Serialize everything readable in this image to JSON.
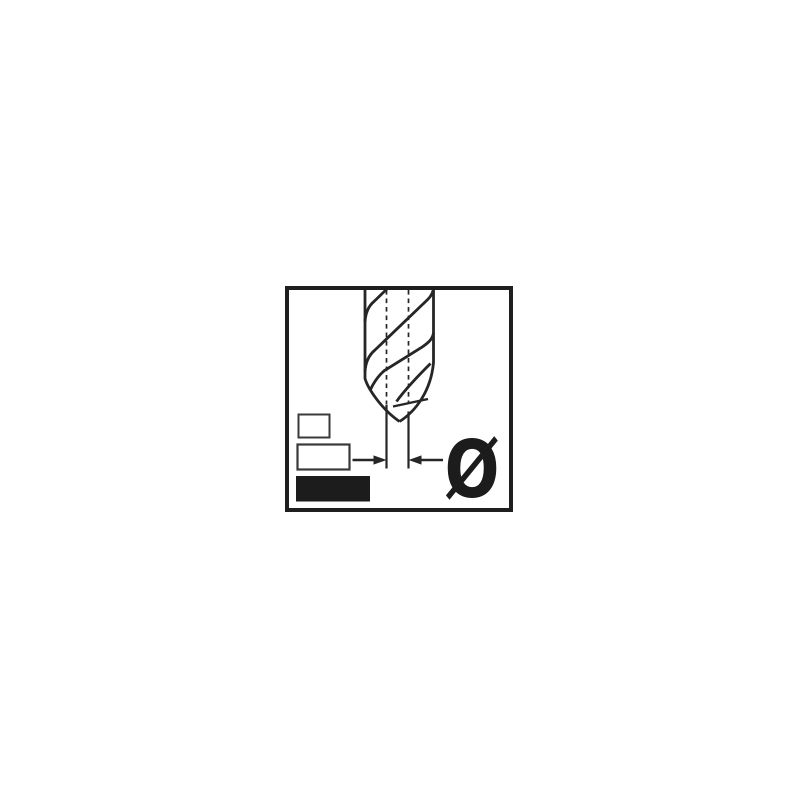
{
  "pictogram": {
    "title": "drill-bit-diameter-pictogram",
    "diameter_symbol": "Ø",
    "colors": {
      "background": "#ffffff",
      "frame": "#1f1f1f",
      "line": "#262626",
      "legend_outline": "#3a3a3a",
      "black_fill": "#1c1c1c"
    },
    "legend": [
      {
        "style": "outlined"
      },
      {
        "style": "outlined"
      },
      {
        "style": "filled"
      }
    ]
  }
}
